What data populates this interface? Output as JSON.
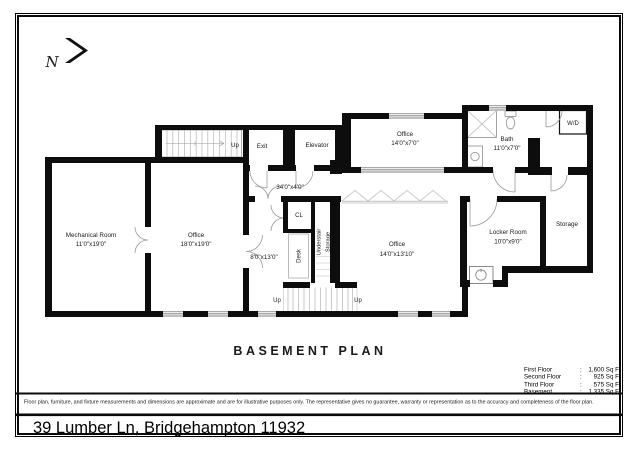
{
  "north": {
    "letter": "N"
  },
  "plan": {
    "title": "BASEMENT PLAN",
    "rooms": {
      "mechanical": {
        "name": "Mechanical Room",
        "dims": "11'0\"x19'0\""
      },
      "office_west": {
        "name": "Office",
        "dims": "18'0\"x19'0\""
      },
      "office_top": {
        "name": "Office",
        "dims": "14'0\"x7'0\""
      },
      "office_center": {
        "name": "Office",
        "dims": "14'0\"x13'10\""
      },
      "bath": {
        "name": "Bath",
        "dims": "11'0\"x7'0\""
      },
      "locker": {
        "name": "Locker Room",
        "dims": "10'0\"x9'0\""
      },
      "storage": {
        "name": "Storage"
      },
      "small_room": {
        "dims": "8'0\"x13'0\""
      },
      "hallway": {
        "dims": "34'0\"x4'0\""
      },
      "closet": {
        "name": "CL"
      },
      "desk": {
        "name": "Desk"
      },
      "understair": {
        "line1": "Understair",
        "line2": "Storage"
      },
      "wd": {
        "name": "W/D"
      },
      "exit": {
        "name": "Exit"
      },
      "elevator": {
        "name": "Elevator"
      }
    },
    "stair_labels": {
      "top": "Up",
      "bottom_left": "Up",
      "bottom_right": "Up"
    }
  },
  "areas": {
    "rows": [
      {
        "label": "First Floor",
        "colon": ":",
        "value": "1,600 Sq Ft"
      },
      {
        "label": "Second Floor",
        "colon": ":",
        "value": "925 Sq Ft"
      },
      {
        "label": "Third Floor",
        "colon": ":",
        "value": "575 Sq Ft"
      },
      {
        "label": "Basement",
        "colon": ":",
        "value": "1,335 Sq Ft"
      }
    ]
  },
  "footer": {
    "disclaimer": "Floor plan, furniture, and fixture measurements and dimensions are approximate and are for illustrative purposes only. The representative gives no guarantee, warranty or representation as to the accuracy and completeness of the floor plan.",
    "address": "39 Lumber Ln, Bridgehampton 11932"
  }
}
